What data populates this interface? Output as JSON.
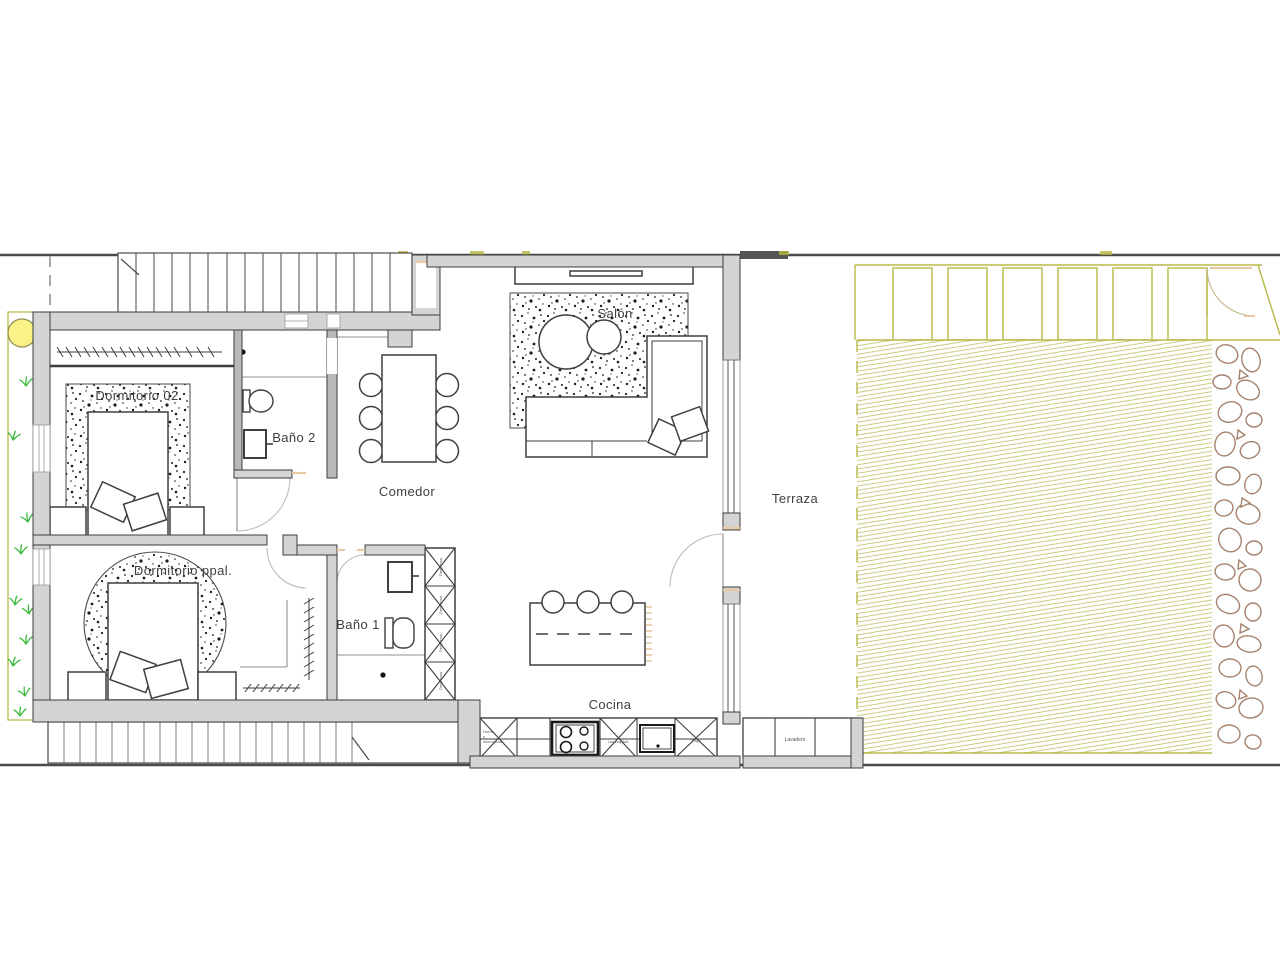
{
  "labels": {
    "bedroom2": "Dormitorio 02",
    "bath2": "Baño 2",
    "dining": "Comedor",
    "living": "Salón",
    "terrace": "Terraza",
    "master_bedroom": "Dormitorio ppal.",
    "bath1": "Baño 1",
    "kitchen": "Cocina",
    "laundry": "Lavadero",
    "pantry": "Despensa"
  },
  "appliances": {
    "oven_lines": [
      "Horno",
      "y",
      "microondas"
    ],
    "dishwasher": "Lavavajillas",
    "fridge": "Frigo"
  },
  "colors": {
    "wall_fill": "#d4d4d4",
    "wall_stroke": "#3d3d3d",
    "site_line": "#4a4a4a",
    "garden_border": "#b8b84a",
    "lawn_hatch": "#c2c26a",
    "tree_fill": "#f9f286",
    "grass": "#3dbb3d",
    "rock_stroke": "#a5826d",
    "door_frame": "#e9c9a3",
    "label_text": "#3f3f3f"
  }
}
